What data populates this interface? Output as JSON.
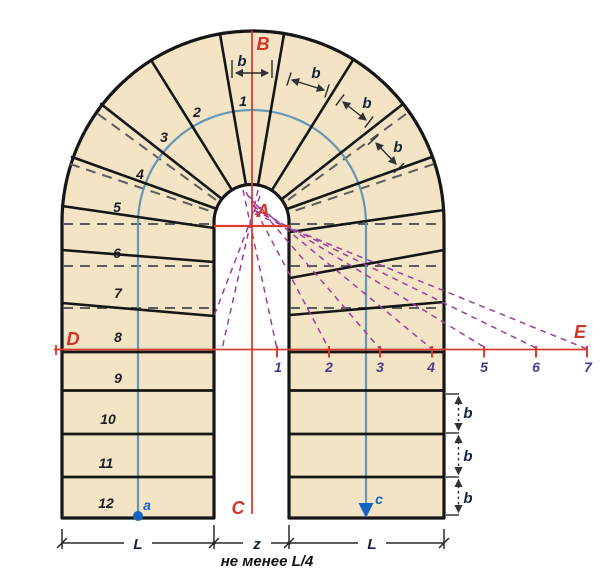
{
  "title": "U-shaped winder staircase layout diagram",
  "colors": {
    "tread_fill": "#f3e4c6",
    "outline": "#161616",
    "guide_gray": "#5c5c5c",
    "axis_red": "#dc3b2e",
    "walkline_blue": "#6498b6",
    "marker_blue": "#1465c0",
    "construction_purple": "#9a3f9e",
    "axis_number_color": "#4a3b8e"
  },
  "points": {
    "A": "A",
    "B": "B",
    "C": "C",
    "D": "D",
    "E": "E"
  },
  "walkline": {
    "start": "a",
    "end": "c"
  },
  "labels": {
    "step_numbers": [
      "1",
      "2",
      "3",
      "4",
      "5",
      "6",
      "7",
      "8",
      "9",
      "10",
      "11",
      "12"
    ],
    "axis_numbers": [
      "1",
      "2",
      "3",
      "4",
      "5",
      "6",
      "7"
    ]
  },
  "dimensions": {
    "tread_width": "b",
    "flight_width": "L",
    "well_gap": "z",
    "note": "не менее L/4"
  }
}
